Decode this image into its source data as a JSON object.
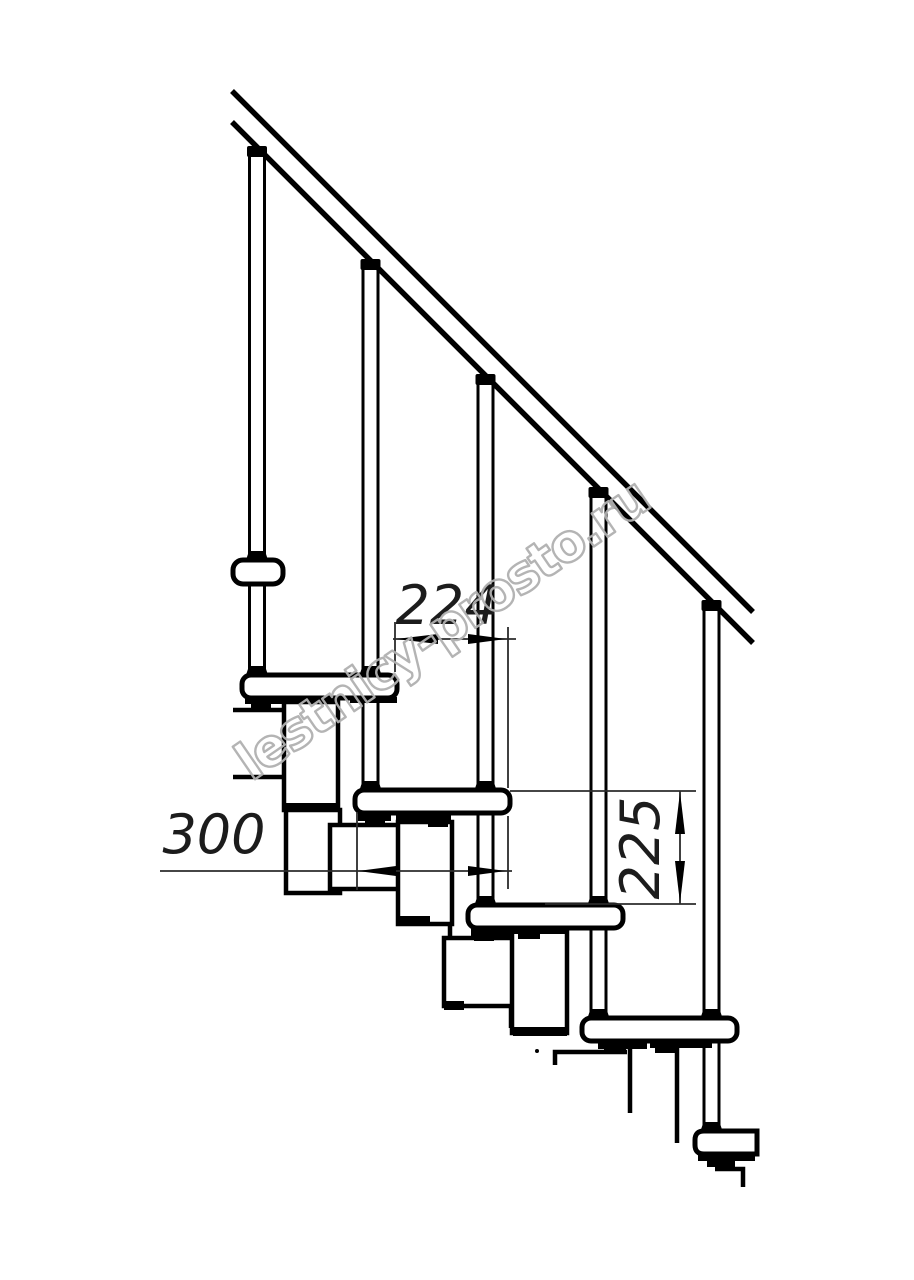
{
  "page": {
    "background": "#ffffff",
    "subject": "Modular staircase side elevation technical drawing"
  },
  "drawing": {
    "dimensions": {
      "step_run": {
        "label": "224",
        "orientation": "horizontal"
      },
      "tread_depth": {
        "label": "300",
        "orientation": "horizontal"
      },
      "riser_height": {
        "label": "225",
        "orientation": "vertical"
      }
    },
    "watermark": {
      "text": "lestnicy-prosto.ru"
    },
    "colors": {
      "line": "#000000",
      "dimension_line": "#2b2b2b",
      "dimension_text": "#1c1c1c",
      "watermark": "#b0b0b0",
      "background": "#ffffff"
    },
    "counts": {
      "treads": 5,
      "balusters": 5
    }
  }
}
